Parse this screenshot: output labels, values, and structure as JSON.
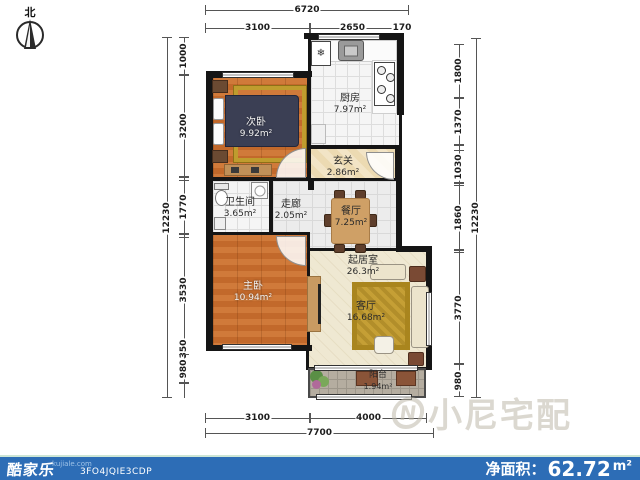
{
  "compass": {
    "north_label": "北"
  },
  "rooms": {
    "second_bedroom": {
      "name": "次卧",
      "area": "9.92m²"
    },
    "kitchen": {
      "name": "厨房",
      "area": "7.97m²"
    },
    "entry": {
      "name": "玄关",
      "area": "2.86m²"
    },
    "bathroom": {
      "name": "卫生间",
      "area": "3.65m²"
    },
    "corridor": {
      "name": "走廊",
      "area": "2.05m²"
    },
    "dining": {
      "name": "餐厅",
      "area": "7.25m²"
    },
    "living_area": {
      "name": "起居室",
      "area": "26.3m²"
    },
    "living_room": {
      "name": "客厅",
      "area": "16.68m²"
    },
    "master_bedroom": {
      "name": "主卧",
      "area": "10.94m²"
    },
    "balcony": {
      "name": "阳台",
      "area": "1.94m²"
    }
  },
  "dims": {
    "top": {
      "overall": "6720",
      "segments": [
        "3100",
        "2650",
        "170"
      ]
    },
    "bottom": {
      "overall": "7700",
      "segments": [
        "3100",
        "4000"
      ]
    },
    "left": {
      "overall": "12230",
      "segments": [
        "1000",
        "3200",
        "1770",
        "3530",
        "350",
        "980"
      ]
    },
    "right": {
      "overall": "12230",
      "segments": [
        "1800",
        "1370",
        "1030",
        "1860",
        "3770",
        "980"
      ]
    }
  },
  "icons": {
    "fridge_snowflake": "❄",
    "watermark_logo_letter": "N"
  },
  "watermark": {
    "brand": "小尼宅配"
  },
  "footer": {
    "brand": "酷家乐",
    "brand_site": "kujiale.com",
    "plan_code": "3FO4JQIE3CDP",
    "net_area_label": "净面积：",
    "net_area_value": "62.72",
    "net_area_unit": "m²",
    "colors": {
      "bar": "#2d6db6",
      "accent_line": "#cde6d5",
      "wall": "#151515"
    }
  }
}
